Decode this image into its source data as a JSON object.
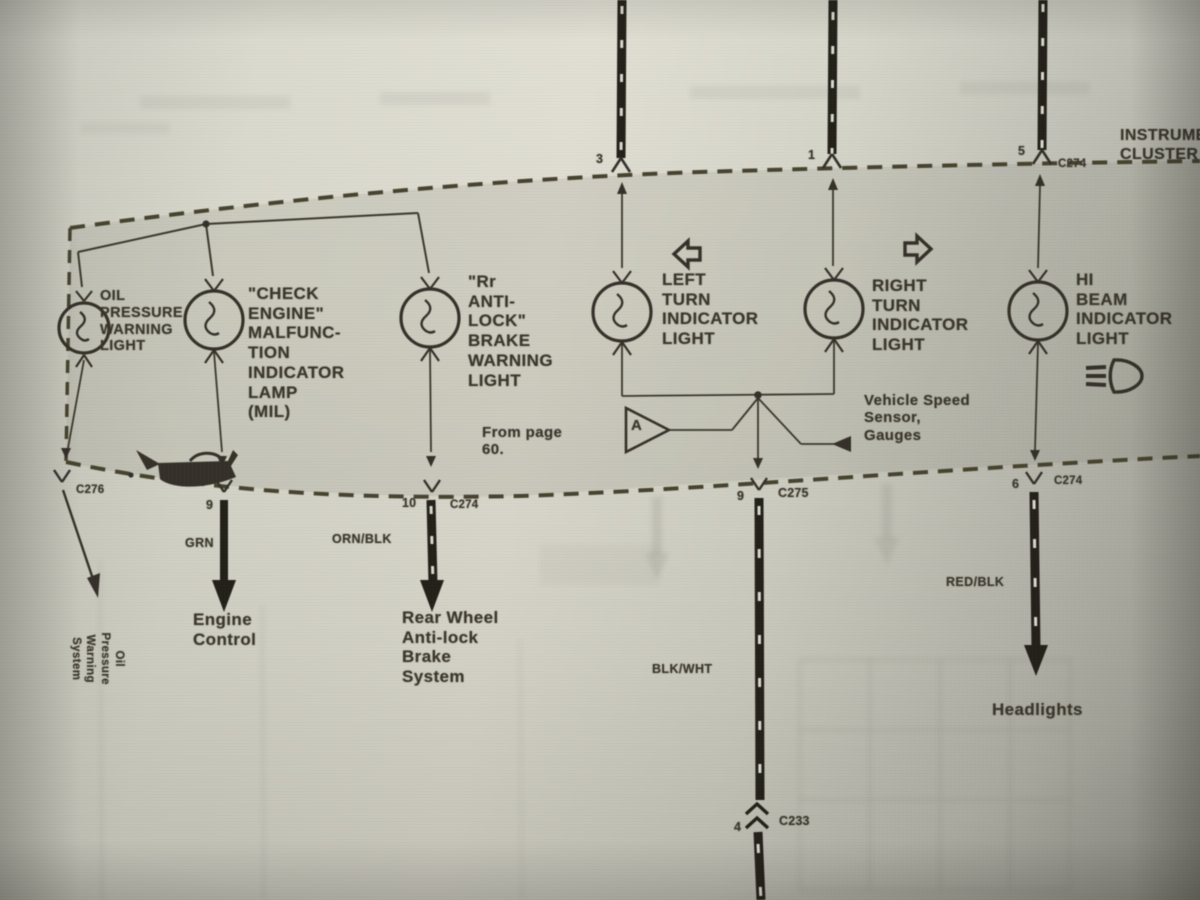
{
  "header": {
    "instrument_cluster": "INSTRUMENT\nCLUSTER"
  },
  "connectors": {
    "top": {
      "pin3": "3",
      "pin1": "1",
      "pin5": "5",
      "c274": "C274"
    },
    "bottom": {
      "oil_c276": "C276",
      "engine_pin": "9",
      "abs_pin": "10",
      "abs_c274": "C274",
      "turn_pin": "9",
      "turn_c275": "C275",
      "beam_pin": "6",
      "beam_c274": "C274",
      "inline_pin": "4",
      "inline_c233": "C233"
    }
  },
  "indicators": {
    "oil": {
      "label": "OIL\nPRESSURE\nWARNING\nLIGHT"
    },
    "check_engine": {
      "label": "\"CHECK\nENGINE\"\nMALFUNC-\nTION\nINDICATOR\nLAMP\n(MIL)"
    },
    "rr_antilock": {
      "label": "\"Rr\nANTI-\nLOCK\"\nBRAKE\nWARNING\nLIGHT",
      "note": "From page\n60."
    },
    "left_turn": {
      "label": "LEFT\nTURN\nINDICATOR\nLIGHT"
    },
    "right_turn": {
      "label": "RIGHT\nTURN\nINDICATOR\nLIGHT"
    },
    "hi_beam": {
      "label": "HI\nBEAM\nINDICATOR\nLIGHT"
    }
  },
  "amplifier": {
    "letter": "A"
  },
  "notes": {
    "vss": "Vehicle Speed\nSensor,\nGauges"
  },
  "wire_colors": {
    "grn": "GRN",
    "orn_blk": "ORN/BLK",
    "blk_wht": "BLK/WHT",
    "red_blk": "RED/BLK"
  },
  "destinations": {
    "oil": "Oil\nPressure\nWarning\nSystem",
    "engine": "Engine\nControl",
    "abs": "Rear Wheel\nAnti-lock\nBrake\nSystem",
    "headlights": "Headlights"
  },
  "colors": {
    "ink": "#3a362c",
    "page_light": "#dedcd0",
    "page_dark": "#9e9d94",
    "band_shade": "#c7c6bb",
    "wire_black": "#24211a"
  }
}
